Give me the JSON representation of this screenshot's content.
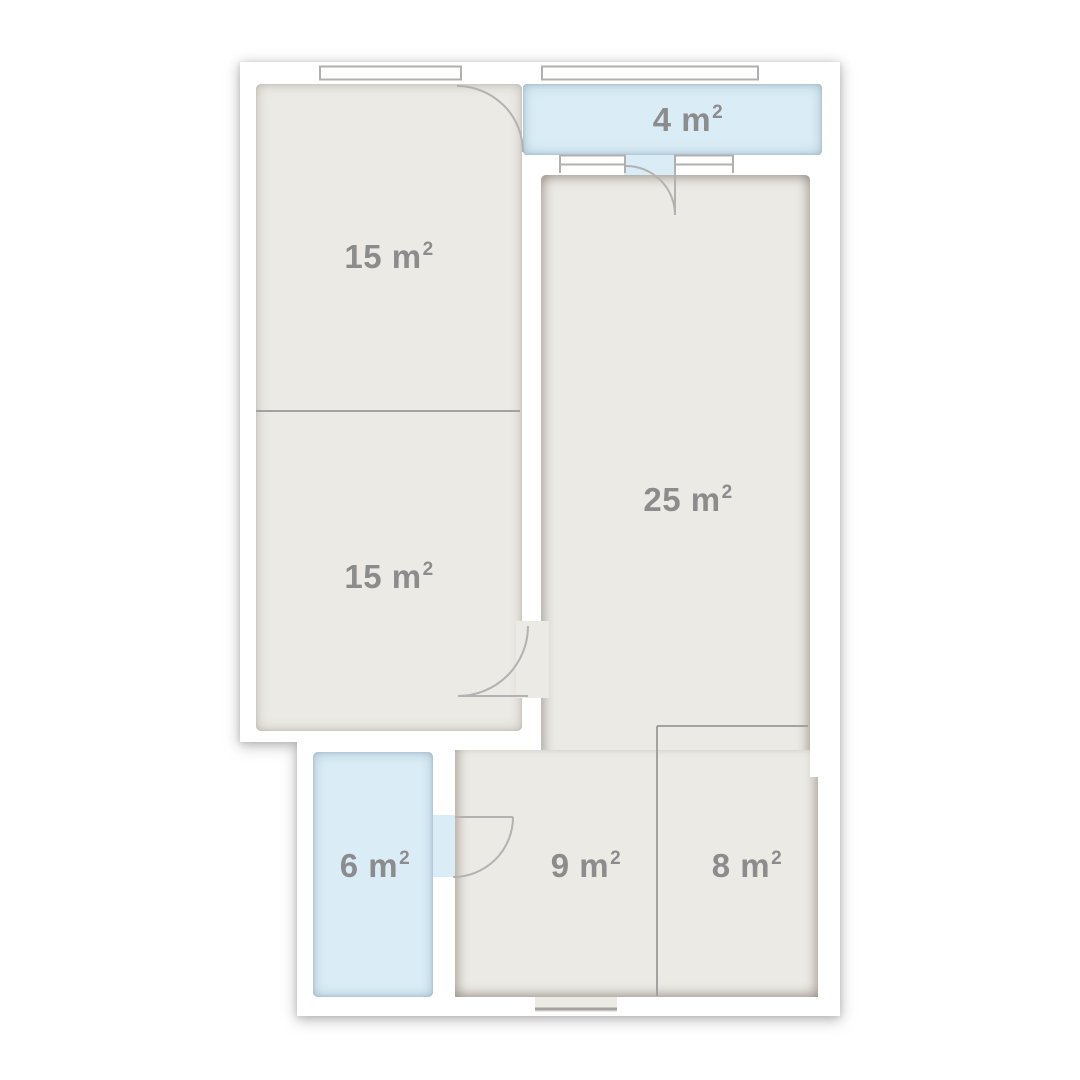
{
  "plan": {
    "type": "apartment-floor-plan",
    "rooms": [
      {
        "id": "room-15-upper",
        "area_label": "15 m",
        "area_sup": "2"
      },
      {
        "id": "room-15-lower",
        "area_label": "15 m",
        "area_sup": "2"
      },
      {
        "id": "balcony-4",
        "area_label": "4 m",
        "area_sup": "2"
      },
      {
        "id": "room-25",
        "area_label": "25 m",
        "area_sup": "2"
      },
      {
        "id": "room-6",
        "area_label": "6 m",
        "area_sup": "2"
      },
      {
        "id": "room-9",
        "area_label": "9 m",
        "area_sup": "2"
      },
      {
        "id": "room-8",
        "area_label": "8 m",
        "area_sup": "2"
      }
    ],
    "colors": {
      "wall": "#FFFFFF",
      "floor": "#ECEAE5",
      "wet_area": "#DAEDF6",
      "plan_lines": "#B2B0AE",
      "divider_lines": "#A4A2A0",
      "label_text": "#8C8C8C"
    }
  }
}
